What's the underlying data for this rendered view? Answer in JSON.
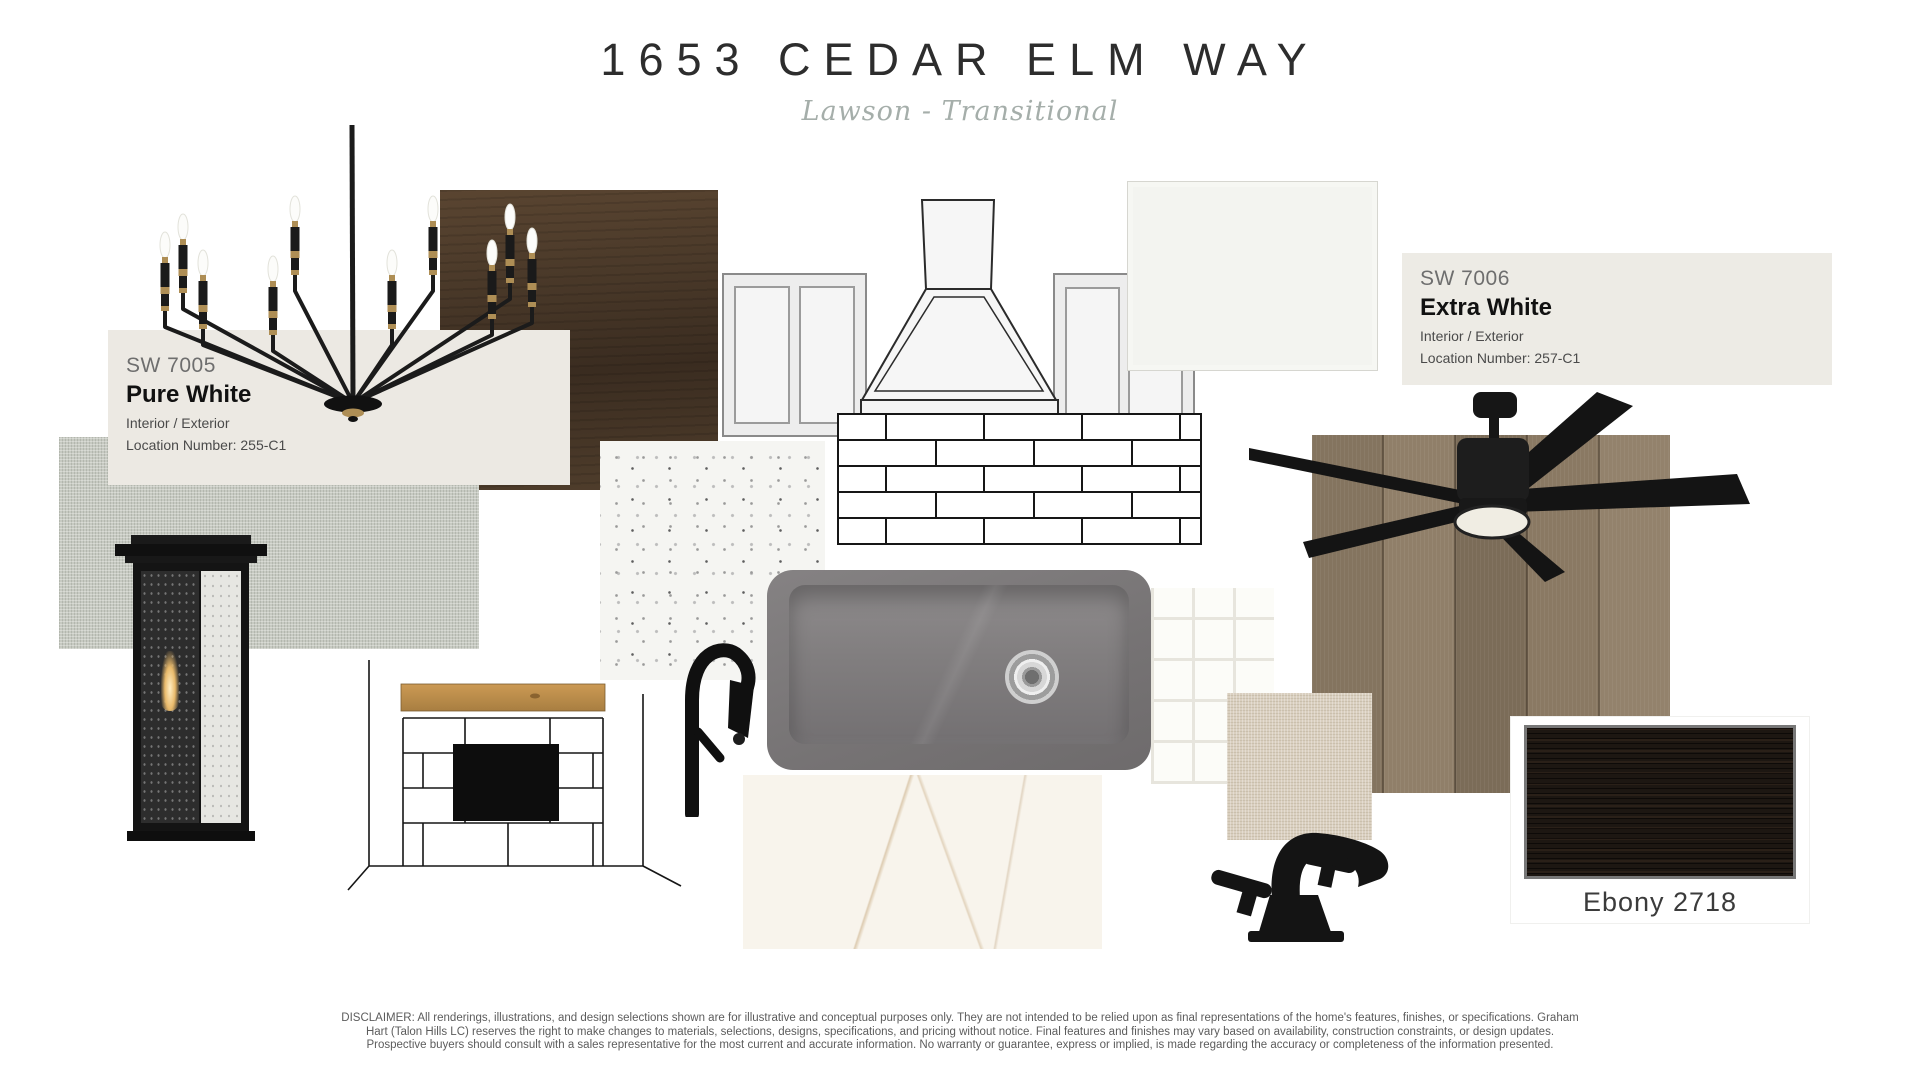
{
  "header": {
    "title": "1653 CEDAR ELM WAY",
    "subtitle": "Lawson - Transitional"
  },
  "paint": {
    "sw7005": {
      "code": "SW 7005",
      "name": "Pure White",
      "usage": "Interior / Exterior",
      "location": "Location Number: 255-C1",
      "swatch_bg": "#ECE9E3"
    },
    "sw7006": {
      "code": "SW 7006",
      "name": "Extra White",
      "usage": "Interior / Exterior",
      "location": "Location Number: 257-C1",
      "swatch_bg": "#EDEBE5"
    }
  },
  "stain": {
    "label": "Ebony 2718",
    "color": "#1D1712"
  },
  "palette": {
    "matte_black": "#161616",
    "brass": "#AE8E55",
    "dark_wood_stain": "#46362A",
    "floor_wood": "#8B7B64",
    "gray_linen": "#C7CAC2",
    "beige_linen": "#D9CFBF",
    "sink_gray": "#7B7879",
    "marble_white": "#F7F2EA",
    "mantel_oak": "#C2924E"
  },
  "disclaimer": {
    "line1": "DISCLAIMER: All renderings, illustrations, and design selections shown are for illustrative and conceptual purposes only. They are not intended to be relied upon as final representations of the home's features, finishes, or specifications. Graham",
    "line2": "Hart (Talon Hills LC) reserves the right to make changes to materials, selections, designs, specifications, and pricing without notice. Final features and finishes may vary based on availability, construction constraints, or design updates.",
    "line3": "Prospective buyers should consult with a sales representative for the most current and accurate information. No warranty or guarantee, express or implied, is made regarding the accuracy or completeness of the information presented."
  }
}
